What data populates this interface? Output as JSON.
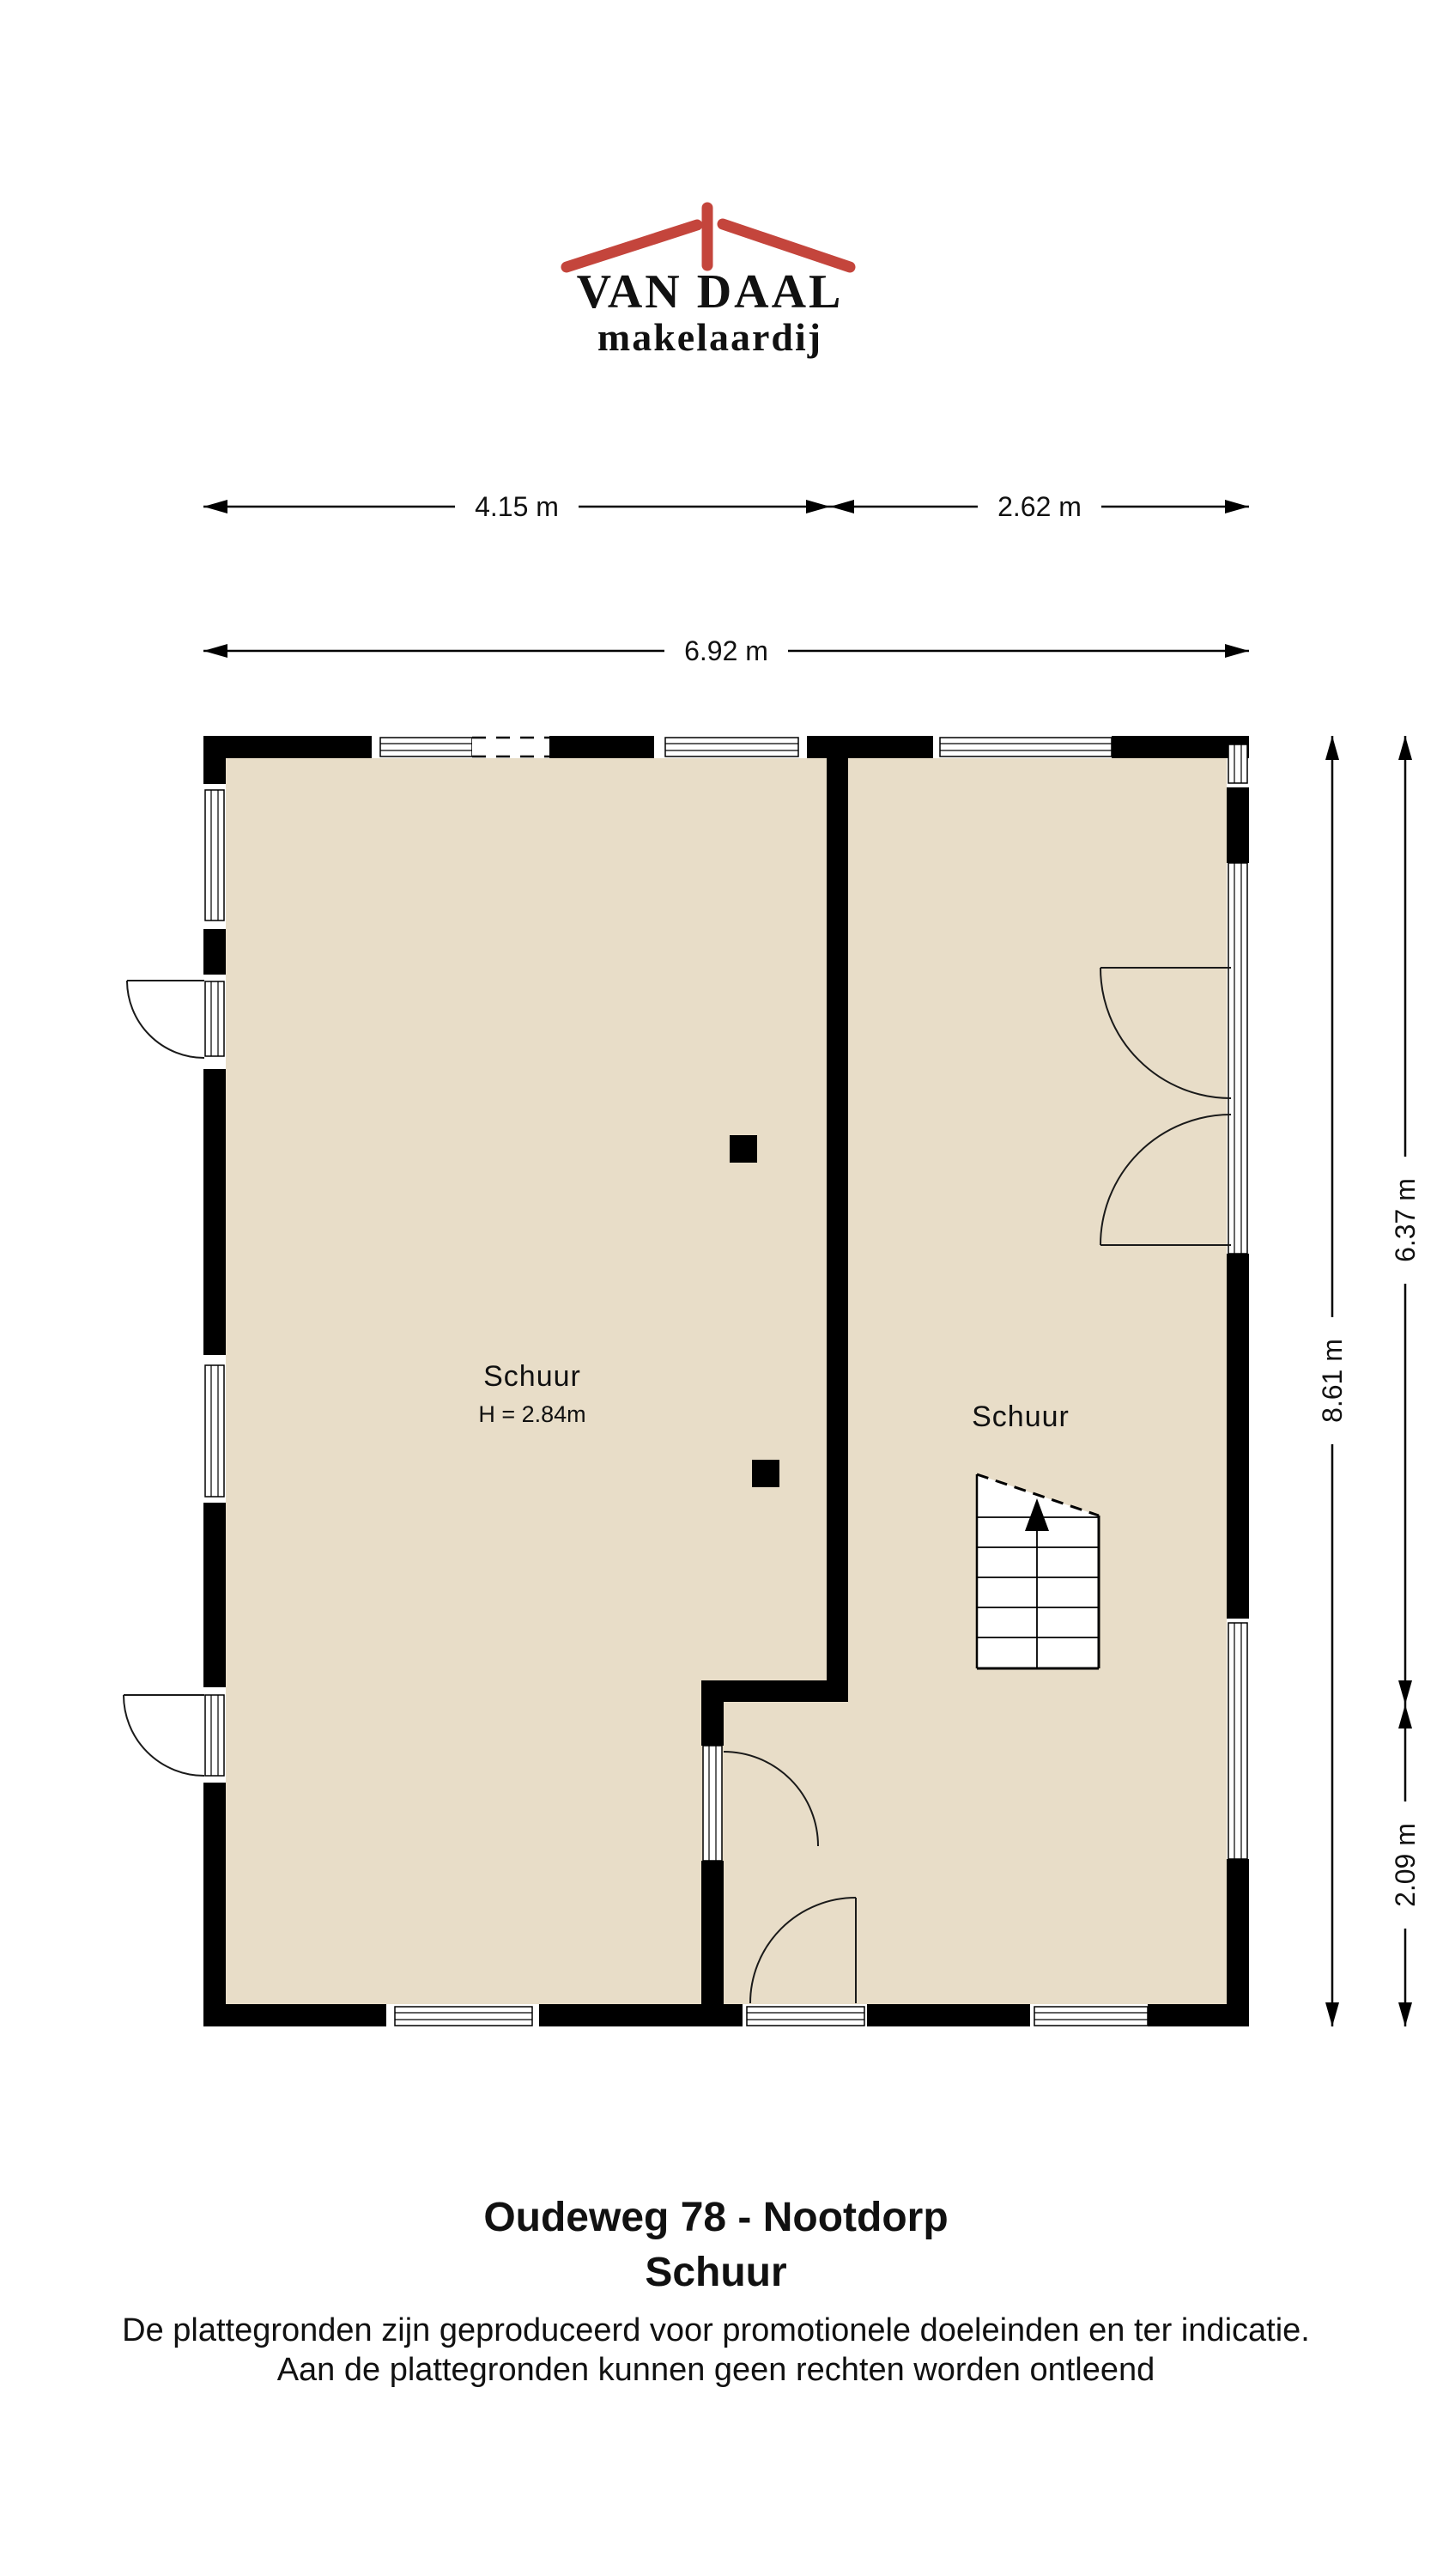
{
  "logo": {
    "line1": "VAN DAAL",
    "line2": "makelaardij"
  },
  "dimensions": {
    "top_left": "4.15 m",
    "top_right": "2.62 m",
    "top_total": "6.92 m",
    "right_full": "8.61 m",
    "right_upper": "6.37 m",
    "right_lower": "2.09 m"
  },
  "rooms": {
    "left": {
      "name": "Schuur",
      "height": "H = 2.84m"
    },
    "right": {
      "name": "Schuur"
    }
  },
  "footer": {
    "title": "Oudeweg 78 - Nootdorp",
    "subtitle": "Schuur",
    "disclaimer1": "De plattegronden zijn geproduceerd voor promotionele doeleinden en ter indicatie.",
    "disclaimer2": "Aan de plattegronden kunnen geen rechten worden ontleend"
  },
  "colors": {
    "floor": "#e8ddc8",
    "wall": "#000000",
    "logo_blue": "#1f3e7d",
    "logo_red": "#c4453c"
  }
}
